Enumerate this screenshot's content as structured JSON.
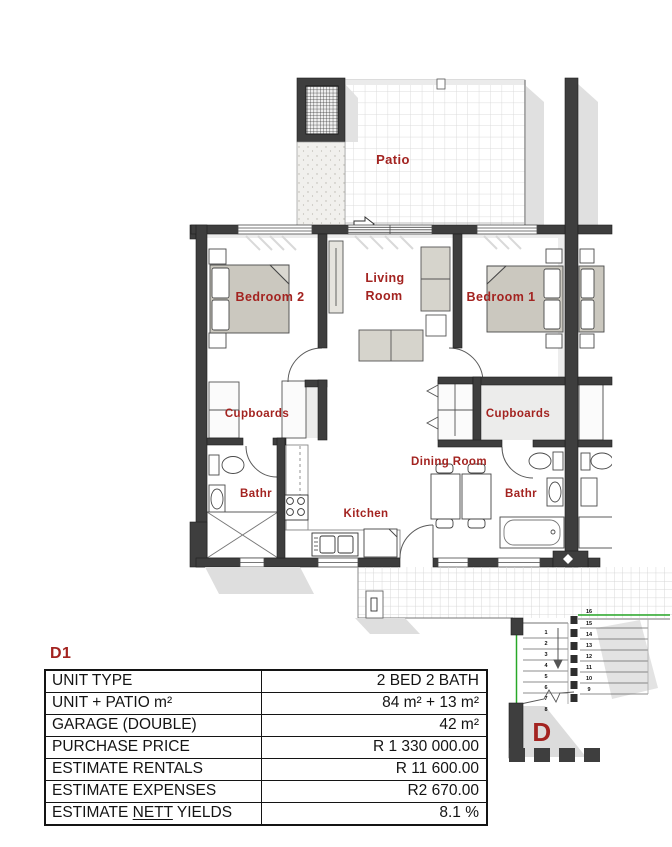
{
  "plan": {
    "labels": {
      "patio": "Patio",
      "bedroom_2": "Bedroom 2",
      "living_line1": "Living",
      "living_line2": "Room",
      "bedroom_1": "Bedroom 1",
      "cupboards_left": "Cupboards",
      "cupboards_right": "Cupboards",
      "dining_room": "Dining Room",
      "bath_left": "Bathr",
      "bath_right": "Bathr",
      "kitchen": "Kitchen",
      "block": "D"
    },
    "stairs": {
      "left": [
        "1",
        "2",
        "3",
        "4",
        "5",
        "6",
        "7",
        "8"
      ],
      "right": [
        "16",
        "15",
        "14",
        "13",
        "12",
        "11",
        "10",
        "9"
      ]
    }
  },
  "unit_card": {
    "id": "D1",
    "rows": [
      {
        "label": "UNIT TYPE",
        "value": "2 BED 2 BATH"
      },
      {
        "label": "UNIT + PATIO m²",
        "value": "84 m² + 13 m²"
      },
      {
        "label": "GARAGE (DOUBLE)",
        "value": "42 m²"
      },
      {
        "label": "PURCHASE PRICE",
        "value": "R 1 330 000.00"
      },
      {
        "label": "ESTIMATE RENTALS",
        "value": "R 11 600.00"
      },
      {
        "label": "ESTIMATE EXPENSES",
        "value": "R2 670.00"
      }
    ],
    "nett_row": {
      "prefix": "ESTIMATE ",
      "underlined": "NETT",
      "suffix": " YIELDS",
      "value": "8.1 %"
    }
  },
  "colors": {
    "label_red": "#a32320",
    "wall": "#3e3e3e",
    "stair_green": "#28a828"
  }
}
